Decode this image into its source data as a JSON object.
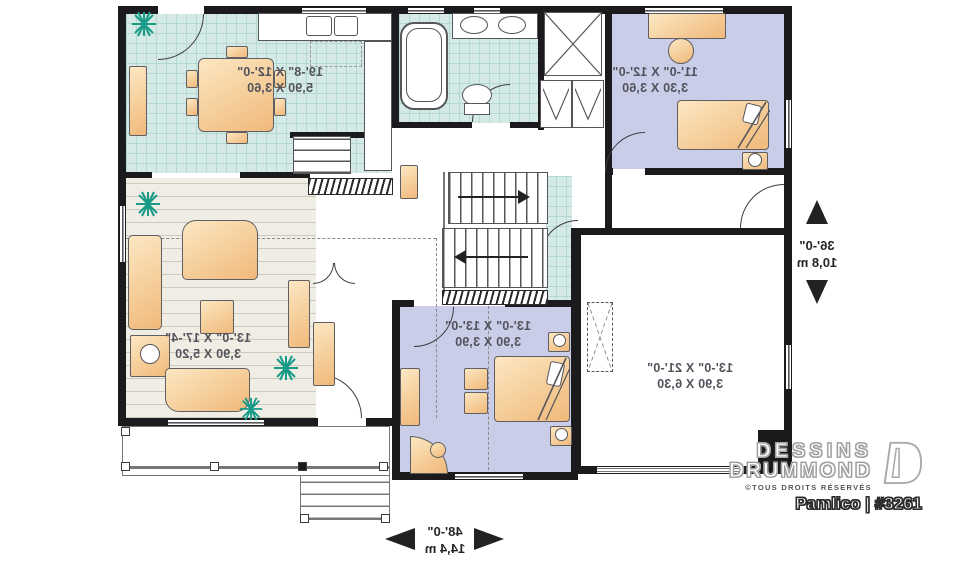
{
  "palette": {
    "wall": "#1b1b1d",
    "tile_floor": "#d5eae6",
    "tile_grid": "#b4d8d2",
    "bedroom_floor": "#c9cde7",
    "wood_floor": "#f0ede4",
    "furniture_light": "#fce7c2",
    "furniture_dark": "#f0b97a",
    "plant_green": "#189a88",
    "label_text": "#52525c",
    "dimension_text": "#26262a",
    "brand_outline": "#9a9a9a",
    "title_outline": "#2b2b2e"
  },
  "rooms": {
    "dining": {
      "imperial": "19'-8\" X 12'-0\"",
      "metric": "5,90 X 3,60"
    },
    "master": {
      "imperial": "11'-0\" X 12'-0\"",
      "metric": "3,30 X 3,60"
    },
    "living": {
      "imperial": "13'-0\" X 17'-4\"",
      "metric": "3,90 X 5,20"
    },
    "bedroom": {
      "imperial": "13'-0\" X 13'-0\"",
      "metric": "3,90 X 3,90"
    },
    "garage": {
      "imperial": "13'-0\" X 21'-0\"",
      "metric": "3,90 X 6,30"
    }
  },
  "dimensions": {
    "depth": {
      "imperial": "36'-0\"",
      "metric": "10,8 m"
    },
    "width": {
      "imperial": "48'-0\"",
      "metric": "14,4 m"
    }
  },
  "branding": {
    "brand_line1": "DESSINS",
    "brand_line2": "DRUMMOND",
    "rights_notice": "©TOUS DROITS RÉSERVÉS",
    "plan_title": "Pamlico | #3261"
  }
}
